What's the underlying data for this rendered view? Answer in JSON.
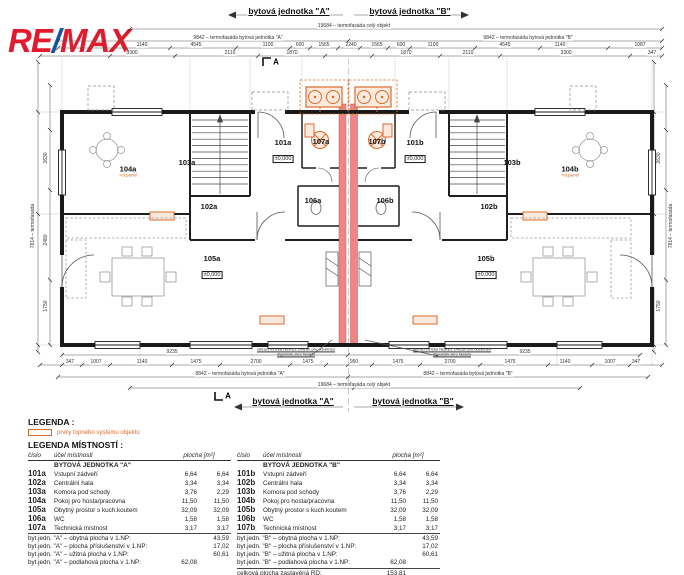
{
  "logo": {
    "re": "RE",
    "slash": "/",
    "max": "MAX"
  },
  "colors": {
    "remax_red": "#e11b2d",
    "remax_blue": "#1356a2",
    "heating_orange": "#d96c2c",
    "party_wall_red": "#ef8585"
  },
  "plan": {
    "labels": [
      {
        "t": "bytová jednotka \"A\"",
        "x": 289,
        "y": 11,
        "cls": "hdr"
      },
      {
        "t": "bytová jednotka \"B\"",
        "x": 410,
        "y": 11,
        "cls": "hdr"
      },
      {
        "t": "19684 – termofasáda celý objekt",
        "x": 354,
        "y": 26
      },
      {
        "t": "9842 – termofasáda bytová jednotka \"A\"",
        "x": 238,
        "y": 38
      },
      {
        "t": "9842 – termofasáda bytová jednotka \"B\"",
        "x": 528,
        "y": 38
      },
      {
        "t": "1140",
        "x": 142,
        "y": 45
      },
      {
        "t": "4545",
        "x": 196,
        "y": 45
      },
      {
        "t": "1100",
        "x": 268,
        "y": 45
      },
      {
        "t": "600",
        "x": 300,
        "y": 45
      },
      {
        "t": "1565",
        "x": 324,
        "y": 45
      },
      {
        "t": "2240",
        "x": 351,
        "y": 45
      },
      {
        "t": "1565",
        "x": 377,
        "y": 45
      },
      {
        "t": "600",
        "x": 401,
        "y": 45
      },
      {
        "t": "1100",
        "x": 433,
        "y": 45
      },
      {
        "t": "4545",
        "x": 505,
        "y": 45
      },
      {
        "t": "1140",
        "x": 560,
        "y": 45
      },
      {
        "t": "1087",
        "x": 640,
        "y": 45
      },
      {
        "t": "3300",
        "x": 132,
        "y": 53
      },
      {
        "t": "2110",
        "x": 230,
        "y": 53
      },
      {
        "t": "1870",
        "x": 292,
        "y": 53
      },
      {
        "t": "1870",
        "x": 406,
        "y": 53
      },
      {
        "t": "2110",
        "x": 468,
        "y": 53
      },
      {
        "t": "3300",
        "x": 566,
        "y": 53
      },
      {
        "t": "347",
        "x": 652,
        "y": 53
      },
      {
        "t": "A",
        "x": 276,
        "y": 62,
        "cls": "sect"
      },
      {
        "t": "7814 – termofasáda",
        "x": 33,
        "y": 226,
        "cls": "rot"
      },
      {
        "t": "2630",
        "x": 46,
        "y": 158,
        "cls": "rot"
      },
      {
        "t": "2480",
        "x": 46,
        "y": 240,
        "cls": "rot"
      },
      {
        "t": "1750",
        "x": 46,
        "y": 306,
        "cls": "rot"
      },
      {
        "t": "7814 – termofasáda",
        "x": 671,
        "y": 226,
        "cls": "rot"
      },
      {
        "t": "2630",
        "x": 659,
        "y": 158,
        "cls": "rot"
      },
      {
        "t": "1750",
        "x": 659,
        "y": 306,
        "cls": "rot"
      },
      {
        "t": "9235",
        "x": 172,
        "y": 352
      },
      {
        "t": "9235",
        "x": 525,
        "y": 352
      },
      {
        "t": "347",
        "x": 70,
        "y": 362
      },
      {
        "t": "1007",
        "x": 96,
        "y": 362
      },
      {
        "t": "1140",
        "x": 142,
        "y": 362
      },
      {
        "t": "1475",
        "x": 196,
        "y": 362
      },
      {
        "t": "2700",
        "x": 256,
        "y": 362
      },
      {
        "t": "1475",
        "x": 308,
        "y": 362
      },
      {
        "t": "950",
        "x": 354,
        "y": 362
      },
      {
        "t": "1475",
        "x": 398,
        "y": 362
      },
      {
        "t": "2700",
        "x": 450,
        "y": 362
      },
      {
        "t": "1475",
        "x": 510,
        "y": 362
      },
      {
        "t": "1140",
        "x": 565,
        "y": 362
      },
      {
        "t": "1007",
        "x": 610,
        "y": 362
      },
      {
        "t": "347",
        "x": 636,
        "y": 362
      },
      {
        "t": "8842 – termofasáda bytová jednotka \"A\"",
        "x": 240,
        "y": 374
      },
      {
        "t": "8842 – termofasáda bytová jednotka \"B\"",
        "x": 468,
        "y": 374
      },
      {
        "t": "19684 – termofasáda celý objekt",
        "x": 354,
        "y": 385
      },
      {
        "t": "A",
        "x": 228,
        "y": 396,
        "cls": "sect"
      },
      {
        "t": "bytová jednotka \"A\"",
        "x": 293,
        "y": 401,
        "cls": "hdr"
      },
      {
        "t": "bytová jednotka \"B\"",
        "x": 413,
        "y": 401,
        "cls": "hdr"
      },
      {
        "t": "větrací mřížka NEREZ DN160 pro odvětrání digestoře skrz fasádu",
        "x": 296,
        "y": 352,
        "cls": "note"
      },
      {
        "t": "větrací mřížka NEREZ DN160 pro odvětrání digestoře skrz fasádu",
        "x": 452,
        "y": 352,
        "cls": "note"
      }
    ],
    "rooms": [
      {
        "id": "101a",
        "x": 283,
        "y": 152,
        "lvl": "±0,000"
      },
      {
        "id": "102a",
        "x": 209,
        "y": 207
      },
      {
        "id": "103a",
        "x": 187,
        "y": 163
      },
      {
        "id": "104a",
        "x": 128,
        "y": 172,
        "sub": "+el.panel"
      },
      {
        "id": "105a",
        "x": 212,
        "y": 268,
        "lvl": "±0,000"
      },
      {
        "id": "106a",
        "x": 313,
        "y": 201
      },
      {
        "id": "107a",
        "x": 321,
        "y": 142
      },
      {
        "id": "101b",
        "x": 415,
        "y": 152,
        "lvl": "±0,000"
      },
      {
        "id": "102b",
        "x": 489,
        "y": 207
      },
      {
        "id": "103b",
        "x": 512,
        "y": 163
      },
      {
        "id": "104b",
        "x": 570,
        "y": 172,
        "sub": "+el.panel"
      },
      {
        "id": "105b",
        "x": 486,
        "y": 268,
        "lvl": "±0,000"
      },
      {
        "id": "106b",
        "x": 385,
        "y": 201
      },
      {
        "id": "107b",
        "x": 377,
        "y": 142
      }
    ]
  },
  "legend": {
    "title": "LEGENDA :",
    "heating_label": "prvky topného systému objektu"
  },
  "rooms_legend": {
    "title": "LEGENDA MÍSTNOSTÍ :",
    "col_cislo": "číslo",
    "col_ucel": "účel místnosti",
    "col_plocha": "plocha [m²]",
    "unit_a": {
      "group": "BYTOVÁ JEDNOTKA \"A\"",
      "rows": [
        [
          "101a",
          "Vstupní zádveří",
          "6,64",
          "6,64"
        ],
        [
          "102a",
          "Centrální hala",
          "3,34",
          "3,34"
        ],
        [
          "103a",
          "Komora pod schody",
          "3,76",
          "2,29"
        ],
        [
          "104a",
          "Pokoj pro hosta/pracovna",
          "11,50",
          "11,50"
        ],
        [
          "105a",
          "Obytný prostor s kuch.koutem",
          "32,09",
          "32,09"
        ],
        [
          "106a",
          "WC",
          "1,58",
          "1,58"
        ],
        [
          "107a",
          "Technická místnost",
          "3,17",
          "3,17"
        ]
      ],
      "summary": [
        [
          "byt.jedn. \"A\" – obytná plocha v 1.NP:",
          "",
          "43,59"
        ],
        [
          "byt.jedn. \"A\" – plocha příslušenství v 1.NP:",
          "",
          "17,02"
        ],
        [
          "byt.jedn. \"A\" – užitná plocha v 1.NP:",
          "",
          "60,61"
        ],
        [
          "byt.jedn. \"A\" – podlahová plocha v 1.NP:",
          "62,08",
          ""
        ]
      ]
    },
    "unit_b": {
      "group": "BYTOVÁ JEDNOTKA \"B\"",
      "rows": [
        [
          "101b",
          "Vstupní zádveří",
          "6,64",
          "6,64"
        ],
        [
          "102b",
          "Centrální hala",
          "3,34",
          "3,34"
        ],
        [
          "103b",
          "Komora pod schody",
          "3,76",
          "2,29"
        ],
        [
          "104b",
          "Pokoj pro hosta/pracovna",
          "11,50",
          "11,50"
        ],
        [
          "105b",
          "Obytný prostor s kuch.koutem",
          "32,09",
          "32,09"
        ],
        [
          "106b",
          "WC",
          "1,58",
          "1,58"
        ],
        [
          "107b",
          "Technická místnost",
          "3,17",
          "3,17"
        ]
      ],
      "summary": [
        [
          "byt.jedn. \"B\" – obytná plocha v 1.NP:",
          "",
          "43,59"
        ],
        [
          "byt.jedn. \"B\" – plocha příslušenství v 1.NP:",
          "",
          "17,02"
        ],
        [
          "byt.jedn. \"B\" – užitná plocha v 1.NP:",
          "",
          "60,61"
        ],
        [
          "byt.jedn. \"B\" – podlahová plocha v 1.NP:",
          "62,08",
          ""
        ]
      ],
      "total_label": "celková plocha zastavěná RD:",
      "total_value": "153,81"
    }
  }
}
